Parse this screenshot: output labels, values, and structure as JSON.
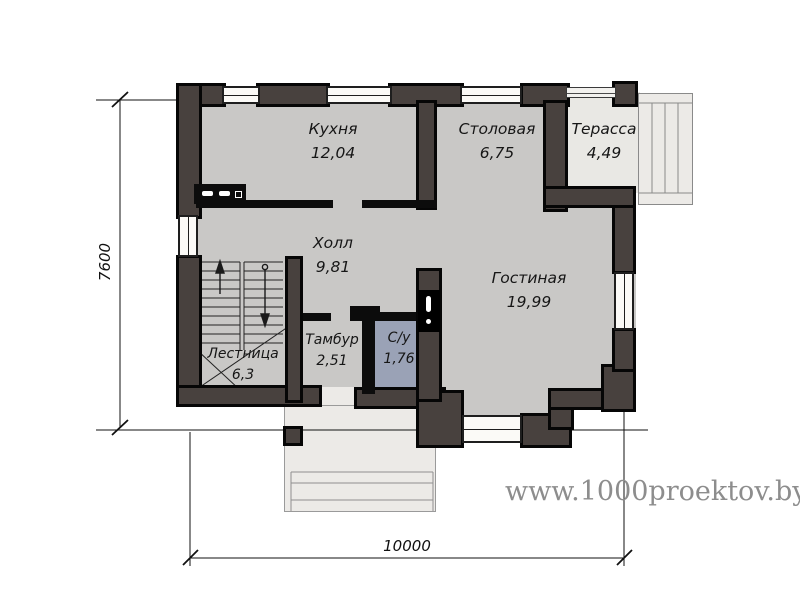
{
  "watermark": {
    "text": "www.1000proektov.by",
    "color": "#8d8d8d"
  },
  "dimensions": {
    "width": "10000",
    "height": "7600"
  },
  "rooms": [
    {
      "name": "Кухня",
      "area": "12,04"
    },
    {
      "name": "Столовая",
      "area": "6,75"
    },
    {
      "name": "Терасса",
      "area": "4,49"
    },
    {
      "name": "Холл",
      "area": "9,81"
    },
    {
      "name": "Гостиная",
      "area": "19,99"
    },
    {
      "name": "Лестница",
      "area": "6,3"
    },
    {
      "name": "Тамбур",
      "area": "2,51"
    },
    {
      "name": "С/у",
      "area": "1,76"
    }
  ],
  "colors": {
    "wall_fill": "#48413e",
    "wall_outline": "#060606",
    "interior_floor": "#c9c8c6",
    "outdoor_floor": "#eceae7",
    "wc_floor": "#9aa2b6",
    "watermark": "#8d8d8d"
  }
}
